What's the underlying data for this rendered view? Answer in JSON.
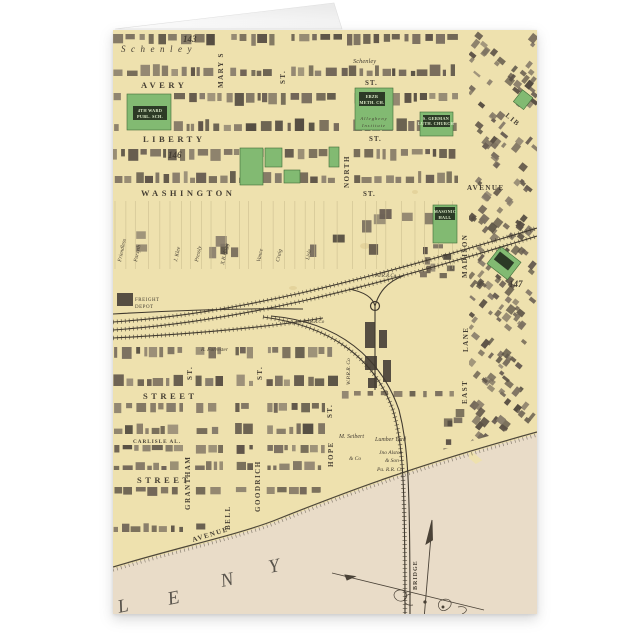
{
  "colors": {
    "paper": "#eee1ae",
    "river": "#e9dcc8",
    "park": "#82ba72",
    "ink": "#453e33",
    "building": "#6b6054"
  },
  "map": {
    "district": "Schenley",
    "plate_143": "143",
    "plate_146": "146",
    "plate_147": "147",
    "streets": {
      "avery": "AVERY",
      "liberty": "LIBERTY",
      "washington": "WASHINGTON",
      "north": "NORTH",
      "mary": "MARY S",
      "madison": "MADISON",
      "avenue": "AVENUE",
      "east": "EAST",
      "lane": "LANE",
      "hope": "HOPE",
      "goodrich": "GOODRICH",
      "grantham": "GRANTHAM",
      "bell": "BELL",
      "carlisle": "CARLISLE AL.",
      "street": "STREET",
      "st": "ST.",
      "lib": "LIB",
      "bridge": "BRIDGE",
      "shore_avenue": "AVENUE"
    },
    "river_letters": [
      "L",
      "E",
      "N",
      "Y"
    ],
    "sites": {
      "ward_school_1": "4TH WARD",
      "ward_school_2": "PUBL. SCH.",
      "ebzr_1": "EBZR",
      "ebzr_2": "METH. CH.",
      "institute_1": "Allegheny",
      "institute_2": "Institute",
      "german_1": "S. GERMAN",
      "german_2": "LUTH. CHURCH",
      "masonic_1": "MASONIC",
      "masonic_2": "HALL",
      "freight_1": "FREIGHT",
      "freight_2": "DEPOT",
      "pa_rr": "Pa.R.R.Co",
      "wprr": "W.P.R.R. Co",
      "seibert_1": "M. Seibert",
      "seibert_2": "& Co",
      "lumber": "Lumber Yard",
      "alston_1": "Jno Alston",
      "alston_2": "& Son",
      "alston_3": "Pa. R.R. Co",
      "forrester": "R. Forrester"
    },
    "owners": [
      "Friendless",
      "Forsyth",
      "J. Klee",
      "Pressly",
      "X.B.Hogg",
      "Vance",
      "Craig",
      "Lisle"
    ]
  }
}
